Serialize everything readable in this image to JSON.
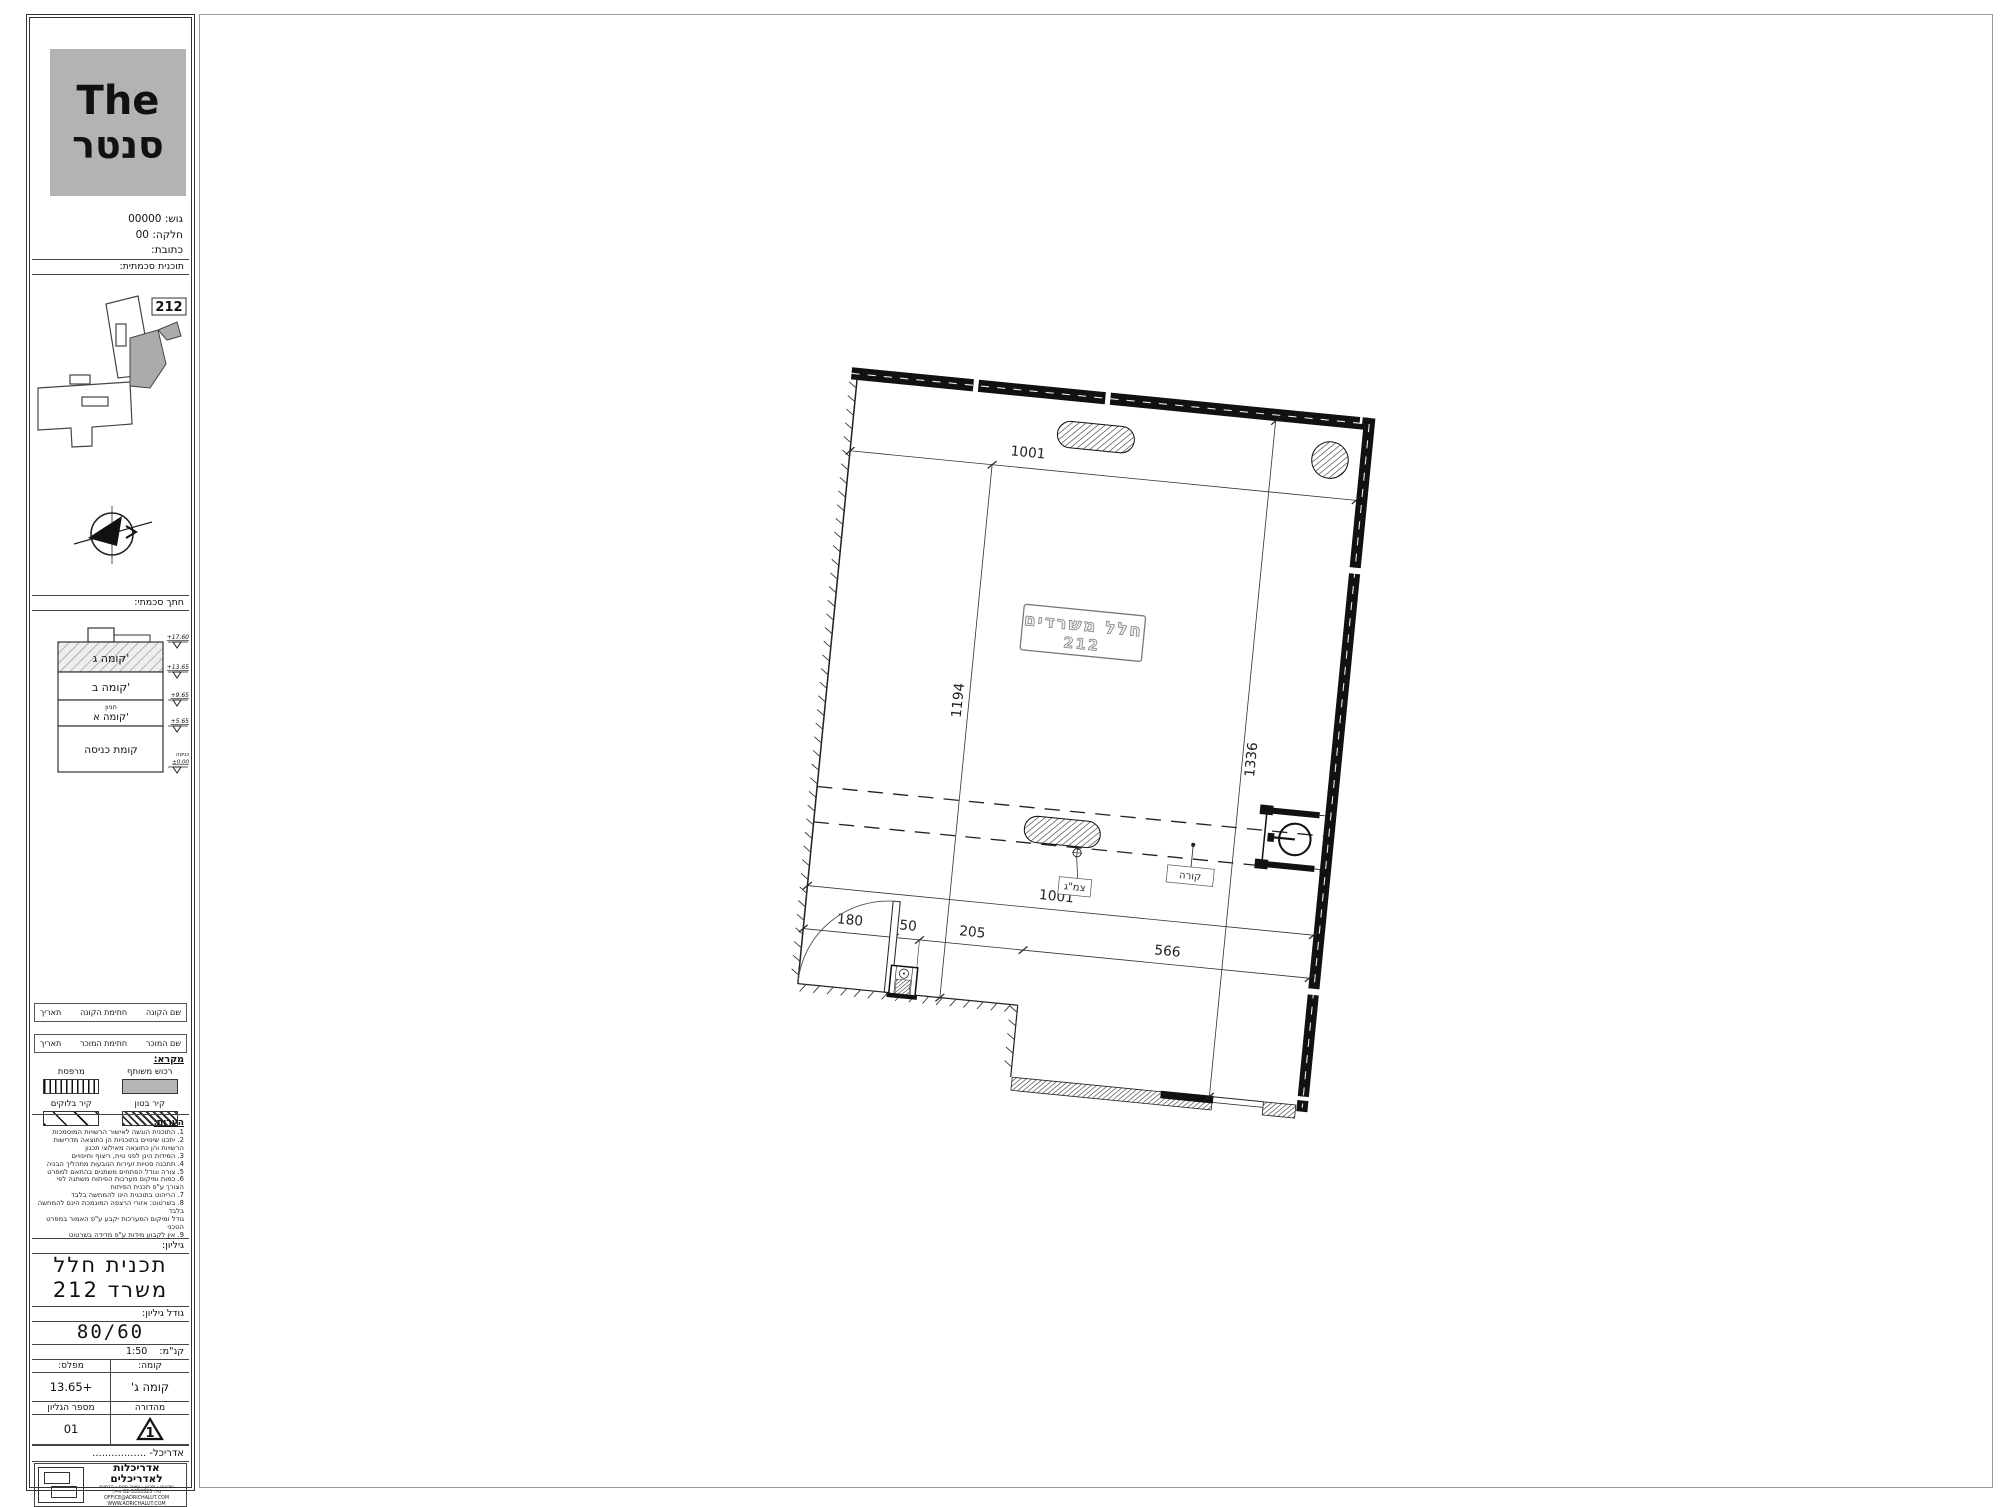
{
  "logo": {
    "line1": "The",
    "line2": "סנטר"
  },
  "project": {
    "block": "גוש: 00000",
    "parcel": "חלקה: 00",
    "address": "כתובת:"
  },
  "headers": {
    "schematic_plan": "תוכנית סכמתית:",
    "schematic_section": "חתך סכמתי:",
    "legend": "מקרא:",
    "notes": "הערות:",
    "sheet": "גיליון:",
    "sheet_size": "גודל גיליון:",
    "scale_label": "קנ\"מ:",
    "scale_value": "1:50",
    "floor_label": "קומה:",
    "level_label": "מפלס:",
    "floor_value": "קומה ג'",
    "level_value": "+13.65",
    "revision_label": "מהדורה",
    "sheet_no_label": "מספר הגליון",
    "revision_value": "1",
    "sheet_no_value": "01",
    "architect_label": "אדריכל-",
    "architect_value": "................."
  },
  "keyplan": {
    "unit": "212"
  },
  "section": {
    "floors": [
      {
        "name": "קומה ג'"
      },
      {
        "name": "קומה ב'"
      },
      {
        "name": "חניון",
        "name2": "קומה א'"
      },
      {
        "name": "קומת כניסה"
      }
    ],
    "levels": [
      "+17.60",
      "+13.65",
      "+9.65",
      "+5.65"
    ],
    "entry_label": "כניסה",
    "entry_value": "±0.00"
  },
  "signatures": {
    "row1": [
      "שם הקונה",
      "חתימת הקונה",
      "תאריך"
    ],
    "row2": [
      "שם המוכר",
      "חתימת המוכר",
      "תאריך"
    ]
  },
  "legend": {
    "items": [
      {
        "label": "רכוש משותף"
      },
      {
        "label": "מרפסת"
      },
      {
        "label": "קיר בטון"
      },
      {
        "label": "קיר בלוקים"
      }
    ]
  },
  "notes": [
    "1. התוכנית הוגשה לאישור הרשויות המוסמכות",
    "2. יתכנו שינויים בתוכניות הן כתוצאה מדרישות",
    "הרשויות והן כתוצאה מאילוצי תכנון",
    "3. המידות הינן לפני טיח, ריצוף וחיפויים",
    "4. תתכנה סטיות זעירות הנובעות מתהליך הבניה",
    "5. צורה וגודל הפתחים משתנים בהתאם למפרט",
    "6. כמות ומיקום מערכות הפיתוח משתנה לפי",
    "הצורך ע\"פ תכנית הפיתוח",
    "7. הריהוט בתוכנית הינו להמחשה בלבד",
    "8. בשרטוט: אזורי הרצפה המונמכת הינם להמחשה בלבד",
    "גודל ומיקום המערכות יקבע ע\"פ האמור במפרט הטכני",
    "9. אין לקבוע מידות ע\"פ מדידה בשרטוט",
    "אלא להיצמד למידות הרשומות בלבד"
  ],
  "title_block": {
    "title_line1": "תכנית חלל",
    "title_line2": "משרד 212",
    "sheet_size_value": "80/60"
  },
  "stamp": {
    "firm": "אדריכלות לאדריכלים",
    "line1": "שרטוט - תכנון - עיצוב פנים - הדמיות",
    "line2": "טל: 02-5353525 מייל: OFFICE@ADRICHALUT.COM",
    "line3": "WWW.ADRICHALUT.COM"
  },
  "plan": {
    "room_name": "חלל משרדים",
    "room_number": "212",
    "dim_top": "1001",
    "dim_bottom": "1001",
    "dim_left": "1194",
    "dim_right": "1336",
    "dim_door": "180",
    "dim_shaft": "50",
    "dim_205": "205",
    "dim_566": "566",
    "beam_label": "קורה",
    "pipe_label": "צמ\"ג"
  }
}
